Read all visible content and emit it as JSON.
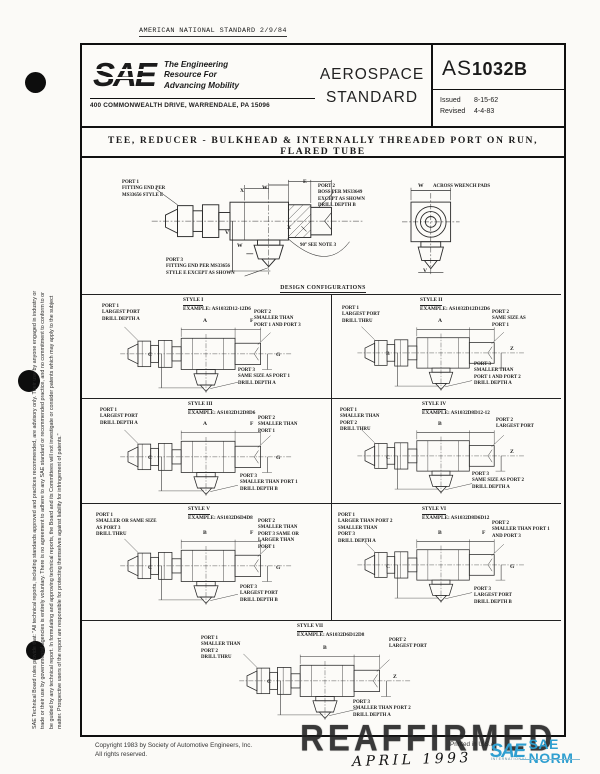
{
  "page": {
    "ans_header": "AMERICAN NATIONAL STANDARD 2/9/84",
    "watermark": "REAFFIRMED",
    "handwritten": "APRIL 1993",
    "printed": "Printed in U.S.A.",
    "copyright_line1": "Copyright  1983  by Society of Automotive Engineers, Inc.",
    "copyright_line2": "All rights reserved.",
    "side_disclaimer": [
      "SAE Technical Board rules provide that: \"All technical reports, including standards approved and practices recommended, are advisory only. Their use by anyone engaged in industry or",
      "trade or their use by governmental agencies is entirely voluntary. There is no agreement to adhere to any SAE standard or recommended practice, and no commitment to conform to or",
      "be guided by any technical report. In formulating and approving technical reports, the Board and its Committees will not investigate or consider patents which may apply to the subject",
      "matter. Prospective users of the report are responsible for protecting themselves against liability for infringement of patents.\""
    ]
  },
  "header": {
    "logo": "SAE",
    "tagline": "The Engineering\nResource For\nAdvancing Mobility",
    "address": "400 COMMONWEALTH DRIVE, WARRENDALE, PA  15096",
    "doc_type_line1": "AEROSPACE",
    "doc_type_line2": "STANDARD",
    "doc_number_prefix": "AS",
    "doc_number": "1032B",
    "issued_label": "Issued",
    "issued_date": "8-15-62",
    "revised_label": "Revised",
    "revised_date": "4-4-83"
  },
  "title": "TEE, REDUCER - BULKHEAD & INTERNALLY THREADED PORT ON RUN, FLARED TUBE",
  "main_figure": {
    "port1": "PORT 1\nFITTING END PER\nMS33656 STYLE E",
    "port2": "PORT 2\nBOSS PER MS33649\nEXCEPT AS SHOWN\nDRILL DEPTH B",
    "port3": "PORT 3\nFITTING END PER MS33656\nSTYLE E EXCEPT AS SHOWN",
    "note": "90° SEE NOTE 3",
    "across_label": "ACROSS WRENCH PADS",
    "dims": {
      "e": "E",
      "x1": "X",
      "w1": "W",
      "v1": "V",
      "w2": "W",
      "x2": "X",
      "w3": "W",
      "v2": "V"
    }
  },
  "section_heading": "DESIGN CONFIGURATIONS",
  "styles": [
    {
      "style": "STYLE I",
      "example": "EXAMPLE:  AS1032D12-12D6",
      "p1": "PORT 1\nLARGEST PORT\nDRILL DEPTH A",
      "p2": "PORT 2\nSMALLER THAN\nPORT 1 AND PORT 3",
      "p3": "PORT 3\nSAME SIZE AS PORT 1\nDRILL DEPTH A",
      "dims": {
        "top1": "A",
        "top2": "F",
        "left": "C",
        "right": "G"
      }
    },
    {
      "style": "STYLE II",
      "example": "EXAMPLE:  AS1032D12D12D6",
      "p1": "PORT 1\nLARGEST PORT\nDRILL THRU",
      "p2": "PORT 2\nSAME SIZE AS\nPORT 1",
      "p3": "PORT 3\nSMALLER THAN\nPORT 1 AND PORT 2\nDRILL DEPTH A",
      "dims": {
        "top1": "A",
        "top2": "",
        "left": "B",
        "right": "Z"
      }
    },
    {
      "style": "STYLE III",
      "example": "EXAMPLE:  AS1032D12D8D6",
      "p1": "PORT 1\nLARGEST PORT\nDRILL DEPTH A",
      "p2": "PORT 2\nSMALLER THAN\nPORT 1",
      "p3": "PORT 3\nSMALLER THAN PORT 1\nDRILL DEPTH B",
      "dims": {
        "top1": "A",
        "top2": "F",
        "left": "C",
        "right": "G"
      }
    },
    {
      "style": "STYLE IV",
      "example": "EXAMPLE:  AS1032D8D12-12",
      "p1": "PORT 1\nSMALLER THAN\nPORT 2\nDRILL THRU",
      "p2": "PORT 2\nLARGEST PORT",
      "p3": "PORT 3\nSAME SIZE AS PORT 2\nDRILL DEPTH A",
      "dims": {
        "top1": "B",
        "top2": "",
        "left": "C",
        "right": "Z"
      }
    },
    {
      "style": "STYLE V",
      "example": "EXAMPLE:  AS1032D6D4D8",
      "p1": "PORT 1\nSMALLER OR SAME SIZE\nAS PORT 3\nDRILL THRU",
      "p2": "PORT 2\nSMALLER THAN\nPORT 3 SAME OR\nLARGER THAN\nPORT 1",
      "p3": "PORT 3\nLARGEST PORT\nDRILL DEPTH B",
      "dims": {
        "top1": "B",
        "top2": "F",
        "left": "C",
        "right": "G"
      }
    },
    {
      "style": "STYLE VI",
      "example": "EXAMPLE:  AS1032D8D6D12",
      "p1": "PORT 1\nLARGER THAN PORT 2\nSMALLER THAN\nPORT 3\nDRILL DEPTH A",
      "p2": "PORT 2\nSMALLER THAN PORT 1\nAND PORT 3",
      "p3": "PORT 3\nLARGEST PORT\nDRILL DEPTH B",
      "dims": {
        "top1": "B",
        "top2": "F",
        "left": "C",
        "right": "G"
      }
    },
    {
      "style": "STYLE VII",
      "example": "EXAMPLE:  AS1032D6D12D8",
      "p1": "PORT 1\nSMALLER THAN\nPORT 2\nDRILL THRU",
      "p2": "PORT 2\nLARGEST PORT",
      "p3": "PORT 3\nSMALLER THAN PORT 2\nDRILL DEPTH A",
      "dims": {
        "top1": "B",
        "top2": "",
        "left": "C",
        "right": "Z"
      }
    }
  ],
  "footer_logo": {
    "sae": "SAE",
    "name": "SAE NORM",
    "sub": "INTERNATIONAL",
    "accent": "#2f9fd0"
  }
}
